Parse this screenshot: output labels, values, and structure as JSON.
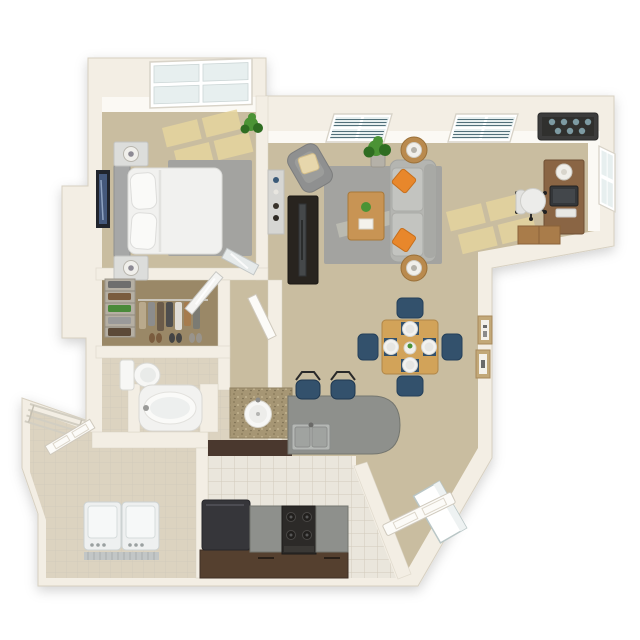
{
  "title": "One-bedroom apartment 3D floor plan (top-down render)",
  "visible_text": [],
  "palette": {
    "bg": "#ffffff",
    "wall": "#f3eee4",
    "wall_edge": "#d7d0c1",
    "wall_bright": "#fbf9f4",
    "carpet": "#c9bda0",
    "sunlight": "#e6d59e",
    "rug": "#a3a3a0",
    "rug_sun": "#bdbdb3",
    "tile": "#eae6dc",
    "tile_bath": "#dcd3c0",
    "grout": "#d2cbbb",
    "closet_floor": "#9a8867",
    "wood": "#d2a359",
    "wood_dark": "#8a6544",
    "navy": "#33516c",
    "navy_dark": "#24405a",
    "orange": "#e8872b",
    "sofa": "#b4b5b1",
    "sofa_light": "#c3c4c0",
    "counter": "#8e908c",
    "cabinet": "#55402f",
    "appliance": "#36363a",
    "white_goods": "#eef0f0",
    "plant": "#4b9335",
    "plant_dark": "#2f6d22",
    "glass": "#e7efef",
    "blinds": "#41626d",
    "frame_tan": "#c2a878",
    "granite": "#a69674",
    "divider": "#4a382e",
    "steel": "#b4b7b4",
    "art_blue": "#45597c"
  },
  "rooms": [
    {
      "name": "Bedroom",
      "position": "top-left",
      "furniture": [
        "queen bed with white duvet",
        "gray headboard",
        "two nightstands",
        "two table lamps",
        "gray area rug",
        "framed wall art",
        "potted plant",
        "bay window",
        "sunlight patches",
        "leaning mirror"
      ]
    },
    {
      "name": "Living room",
      "position": "top-center",
      "furniture": [
        "gray sofa",
        "two orange accent pillows",
        "wood coffee table with plant and book",
        "gray area rug",
        "angled armchair with tan pillow",
        "dark TV stand",
        "flat TV",
        "two round end tables with lamps",
        "potted plant",
        "sideboard with decor",
        "two windows with blinds"
      ]
    },
    {
      "name": "Office nook",
      "position": "top-right",
      "furniture": [
        "wood desk",
        "computer monitor",
        "keyboard",
        "desk lamp",
        "office chair on casters",
        "low cabinet",
        "corner window",
        "dark ceiling vent fixture"
      ]
    },
    {
      "name": "Dining area",
      "position": "center-right",
      "furniture": [
        "square wood dining table",
        "four navy chairs",
        "four place settings on navy mats",
        "centerpiece",
        "two framed artworks on wall"
      ]
    },
    {
      "name": "Kitchen",
      "position": "bottom-center",
      "furniture": [
        "gray breakfast-bar island with rounded end",
        "stainless double sink",
        "two bar stools",
        "black range with four burners",
        "dark refrigerator",
        "brown cabinets with gray countertops"
      ]
    },
    {
      "name": "Bathroom",
      "position": "middle-left",
      "furniture": [
        "toilet",
        "oval garden tub in alcove",
        "granite vanity with round sink"
      ]
    },
    {
      "name": "Walk-in closet",
      "position": "left",
      "furniture": [
        "shelving unit with folded clothes",
        "hanging rod with clothes",
        "row of shoes",
        "angled closet door"
      ]
    },
    {
      "name": "Laundry room",
      "position": "bottom-left",
      "furniture": [
        "washer",
        "dryer",
        "corner wire shelving",
        "open paneled door",
        "angled exterior wall"
      ]
    },
    {
      "name": "Entry",
      "position": "bottom-right",
      "furniture": [
        "open entry door on chamfered corner",
        "entry corridor"
      ]
    }
  ]
}
